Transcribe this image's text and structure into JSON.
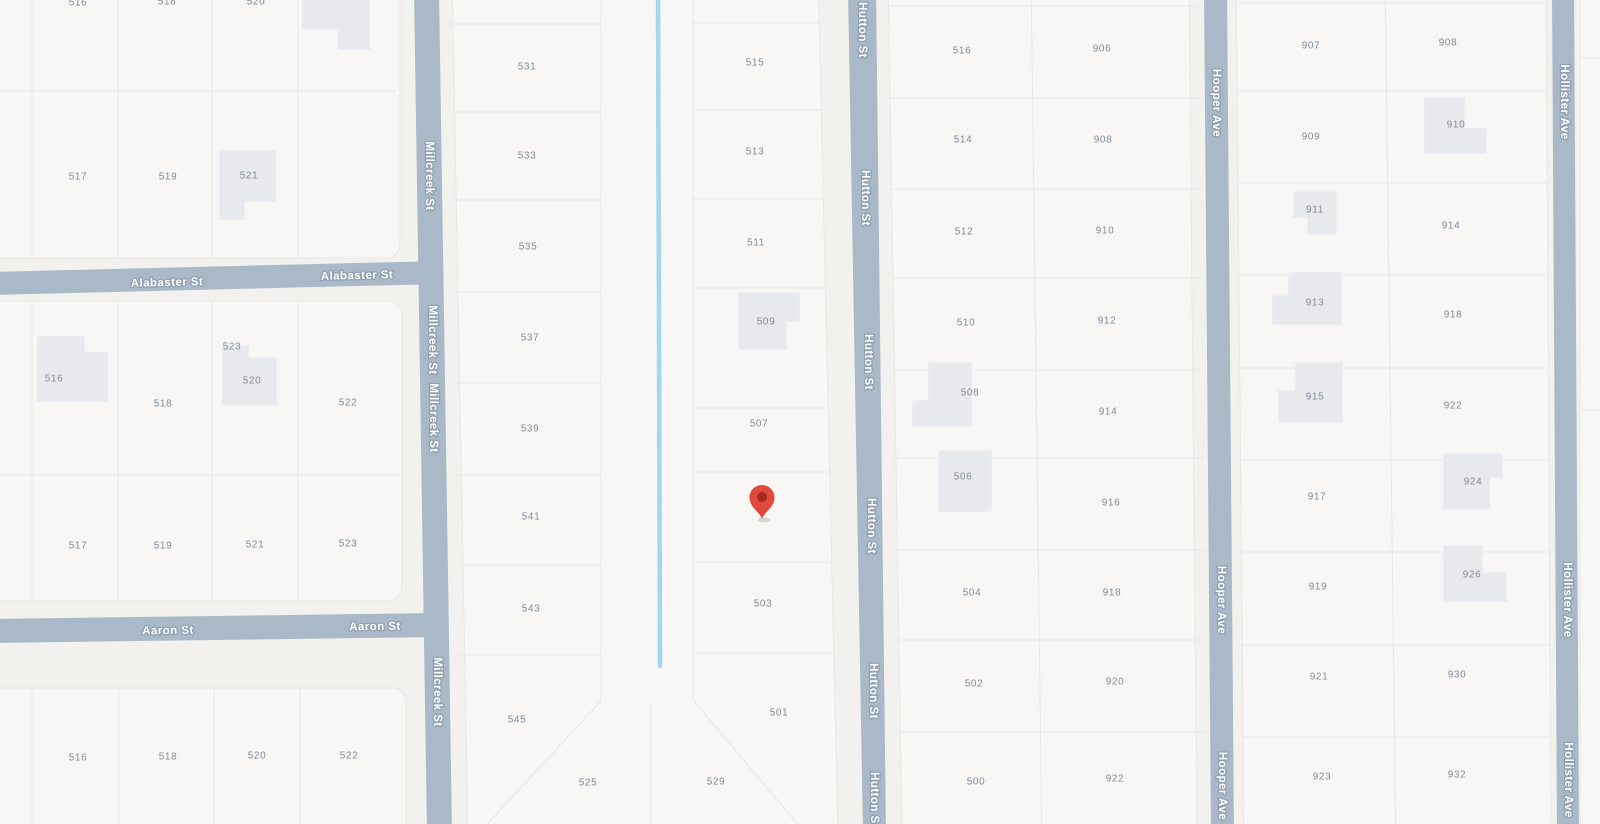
{
  "map": {
    "background": "#f2f1ee",
    "block_fill": "#f8f7f5",
    "block_stroke": "#e8e7e4",
    "parcel_line_color": "#e8e7e4",
    "building_fill": "#e8e9ed",
    "building_stroke": "#f3f4f6",
    "street_fill": "#a9b9c8",
    "street_label_color": "#ffffff",
    "street_label_halo": "#90a0b1",
    "parcel_label_color": "#828a96",
    "creek_color": "#a3d8ec",
    "pin_color": "#e0493c",
    "pin_dot_color": "#a52b1f",
    "blocks": [
      {
        "rect": [
          -30,
          -30,
          430,
          288
        ],
        "rx": 14
      },
      {
        "rect": [
          -30,
          301,
          432,
          300
        ],
        "rx": 14
      },
      {
        "rect": [
          -30,
          688,
          436,
          176
        ],
        "rx": 14
      },
      {
        "points": "452,-30 818,-30 838,834 468,834"
      },
      {
        "points": "888,-30 1189,-30 1197,834 902,834"
      },
      {
        "points": "1236,-30 1546,-30 1551,834 1244,834"
      },
      {
        "rect": [
          1580,
          -30,
          70,
          894
        ],
        "rx": 12
      }
    ],
    "parcel_lines": [
      [
        32,
        -30,
        32,
        258
      ],
      [
        118,
        -30,
        118,
        258
      ],
      [
        212,
        -30,
        212,
        258
      ],
      [
        298,
        -30,
        298,
        258
      ],
      [
        -30,
        91,
        396,
        91
      ],
      [
        32,
        301,
        32,
        601
      ],
      [
        118,
        301,
        118,
        601
      ],
      [
        212,
        301,
        212,
        601
      ],
      [
        298,
        301,
        298,
        601
      ],
      [
        -30,
        475,
        400,
        475
      ],
      [
        32,
        688,
        32,
        834
      ],
      [
        119,
        688,
        119,
        834
      ],
      [
        214,
        688,
        214,
        834
      ],
      [
        300,
        688,
        300,
        834
      ],
      [
        601,
        -30,
        601,
        701
      ],
      [
        693,
        -30,
        693,
        700
      ],
      [
        651,
        702,
        651,
        834
      ],
      [
        601,
        701,
        478,
        834
      ],
      [
        693,
        700,
        806,
        834
      ],
      [
        449,
        24,
        601,
        24
      ],
      [
        450,
        112,
        601,
        112
      ],
      [
        451,
        200,
        601,
        200
      ],
      [
        453,
        292,
        601,
        292
      ],
      [
        455,
        383,
        601,
        383
      ],
      [
        456,
        475,
        601,
        475
      ],
      [
        458,
        565,
        601,
        565
      ],
      [
        459,
        655,
        601,
        655
      ],
      [
        693,
        23,
        819,
        23
      ],
      [
        693,
        110,
        821,
        110
      ],
      [
        693,
        199,
        823,
        199
      ],
      [
        693,
        288,
        825,
        288
      ],
      [
        693,
        408,
        828,
        408
      ],
      [
        693,
        472,
        829,
        472
      ],
      [
        693,
        562,
        831,
        562
      ],
      [
        693,
        653,
        833,
        653
      ],
      [
        1031,
        -30,
        1042,
        854
      ],
      [
        885,
        6,
        1198,
        6
      ],
      [
        890,
        98,
        1200,
        98
      ],
      [
        891,
        189,
        1201,
        189
      ],
      [
        893,
        278,
        1202,
        278
      ],
      [
        894,
        370,
        1203,
        370
      ],
      [
        896,
        458,
        1204,
        458
      ],
      [
        897,
        550,
        1205,
        550
      ],
      [
        899,
        640,
        1206,
        640
      ],
      [
        900,
        732,
        1207,
        732
      ],
      [
        1385,
        -30,
        1396,
        854
      ],
      [
        1236,
        3,
        1546,
        3
      ],
      [
        1237,
        91,
        1547,
        91
      ],
      [
        1238,
        183,
        1547,
        183
      ],
      [
        1239,
        275,
        1548,
        275
      ],
      [
        1240,
        368,
        1548,
        368
      ],
      [
        1240,
        460,
        1549,
        460
      ],
      [
        1241,
        552,
        1549,
        552
      ],
      [
        1242,
        645,
        1550,
        645
      ],
      [
        1243,
        737,
        1550,
        737
      ],
      [
        1580,
        58,
        1650,
        58
      ],
      [
        1582,
        410,
        1650,
        410
      ]
    ],
    "buildings": [
      {
        "points": "302,-20 370,-20 370,50 337,50 337,30 302,30"
      },
      {
        "points": "219,150 276,150 276,202 245,202 245,220 219,220"
      },
      {
        "points": "37,336 85,336 85,352 108,352 108,402 37,402"
      },
      {
        "points": "222,345 249,345 249,357 277,357 277,406 222,406"
      },
      {
        "points": "738,292 800,292 800,322 787,322 787,350 738,350"
      },
      {
        "points": "928,362 972,362 972,427 912,427 912,400 928,400"
      },
      {
        "points": "938,450 992,450 992,512 938,512"
      },
      {
        "points": "1424,97 1465,97 1465,128 1487,128 1487,154 1424,154"
      },
      {
        "points": "1293,191 1337,191 1337,235 1307,235 1307,218 1293,218"
      },
      {
        "points": "1288,272 1342,272 1342,325 1272,325 1272,295 1288,295"
      },
      {
        "points": "1295,362 1343,362 1343,423 1278,423 1278,390 1295,390"
      },
      {
        "points": "1443,453 1503,453 1503,478 1490,478 1490,510 1443,510"
      },
      {
        "points": "1443,545 1483,545 1483,572 1507,572 1507,602 1443,602"
      }
    ],
    "creek": {
      "x1": 658,
      "y1": -10,
      "x2": 660,
      "y2": 666,
      "width": 4.5
    },
    "streets": [
      {
        "name": "Millcreek St",
        "polygon": "414,-10 439,-10 452,834 427,834",
        "labels": [
          {
            "x": 429,
            "y": 176,
            "r": 90
          },
          {
            "x": 432,
            "y": 340,
            "r": 90
          },
          {
            "x": 433,
            "y": 418,
            "r": 90
          },
          {
            "x": 437,
            "y": 692,
            "r": 90
          }
        ]
      },
      {
        "name": "Alabaster St",
        "polygon": "-10,272 440,261 440,284 -10,295",
        "labels": [
          {
            "x": 167,
            "y": 283,
            "r": -1.4
          },
          {
            "x": 357,
            "y": 276,
            "r": -1.4
          }
        ]
      },
      {
        "name": "Aaron St",
        "polygon": "-10,619 440,613 440,637 -10,643",
        "labels": [
          {
            "x": 168,
            "y": 631,
            "r": -0.8
          },
          {
            "x": 375,
            "y": 627,
            "r": -0.8
          }
        ]
      },
      {
        "name": "Hutton St",
        "polygon": "848,-10 876,-10 886,834 863,834",
        "labels": [
          {
            "x": 862,
            "y": 30,
            "r": 90
          },
          {
            "x": 865,
            "y": 198,
            "r": 90
          },
          {
            "x": 868,
            "y": 362,
            "r": 90
          },
          {
            "x": 871,
            "y": 526,
            "r": 90
          },
          {
            "x": 873,
            "y": 691,
            "r": 90
          },
          {
            "x": 874,
            "y": 800,
            "r": 90
          }
        ]
      },
      {
        "name": "Hooper Ave",
        "polygon": "1204,-10 1227,-10 1234,834 1211,834",
        "labels": [
          {
            "x": 1216,
            "y": 103,
            "r": 90
          },
          {
            "x": 1221,
            "y": 600,
            "r": 90
          },
          {
            "x": 1222,
            "y": 786,
            "r": 90
          }
        ]
      },
      {
        "name": "Hollister Ave",
        "polygon": "1552,-10 1574,-10 1579,834 1557,834",
        "labels": [
          {
            "x": 1564,
            "y": 102,
            "r": 90
          },
          {
            "x": 1567,
            "y": 600,
            "r": 90
          },
          {
            "x": 1568,
            "y": 780,
            "r": 90
          }
        ]
      }
    ],
    "parcel_labels": [
      {
        "t": "516",
        "x": 78,
        "y": 3
      },
      {
        "t": "518",
        "x": 167,
        "y": 2
      },
      {
        "t": "520",
        "x": 256,
        "y": 2
      },
      {
        "t": "517",
        "x": 78,
        "y": 177
      },
      {
        "t": "519",
        "x": 168,
        "y": 177
      },
      {
        "t": "521",
        "x": 249,
        "y": 176
      },
      {
        "t": "523",
        "x": 232,
        "y": 347
      },
      {
        "t": "516",
        "x": 54,
        "y": 379
      },
      {
        "t": "520",
        "x": 252,
        "y": 381
      },
      {
        "t": "518",
        "x": 163,
        "y": 404
      },
      {
        "t": "522",
        "x": 348,
        "y": 403
      },
      {
        "t": "517",
        "x": 78,
        "y": 546
      },
      {
        "t": "519",
        "x": 163,
        "y": 546
      },
      {
        "t": "521",
        "x": 255,
        "y": 545
      },
      {
        "t": "523",
        "x": 348,
        "y": 544
      },
      {
        "t": "516",
        "x": 78,
        "y": 758
      },
      {
        "t": "518",
        "x": 168,
        "y": 757
      },
      {
        "t": "520",
        "x": 257,
        "y": 756
      },
      {
        "t": "522",
        "x": 349,
        "y": 756
      },
      {
        "t": "531",
        "x": 527,
        "y": 67
      },
      {
        "t": "533",
        "x": 527,
        "y": 156
      },
      {
        "t": "535",
        "x": 528,
        "y": 247
      },
      {
        "t": "537",
        "x": 530,
        "y": 338
      },
      {
        "t": "539",
        "x": 530,
        "y": 429
      },
      {
        "t": "541",
        "x": 531,
        "y": 517
      },
      {
        "t": "543",
        "x": 531,
        "y": 609
      },
      {
        "t": "545",
        "x": 517,
        "y": 720
      },
      {
        "t": "525",
        "x": 588,
        "y": 783
      },
      {
        "t": "515",
        "x": 755,
        "y": 63
      },
      {
        "t": "513",
        "x": 755,
        "y": 152
      },
      {
        "t": "511",
        "x": 756,
        "y": 243
      },
      {
        "t": "509",
        "x": 766,
        "y": 322
      },
      {
        "t": "507",
        "x": 759,
        "y": 424
      },
      {
        "t": "503",
        "x": 763,
        "y": 604
      },
      {
        "t": "501",
        "x": 779,
        "y": 713
      },
      {
        "t": "529",
        "x": 716,
        "y": 782
      },
      {
        "t": "516",
        "x": 962,
        "y": 51
      },
      {
        "t": "906",
        "x": 1102,
        "y": 49
      },
      {
        "t": "514",
        "x": 963,
        "y": 140
      },
      {
        "t": "908",
        "x": 1103,
        "y": 140
      },
      {
        "t": "512",
        "x": 964,
        "y": 232
      },
      {
        "t": "910",
        "x": 1105,
        "y": 231
      },
      {
        "t": "510",
        "x": 966,
        "y": 323
      },
      {
        "t": "912",
        "x": 1107,
        "y": 321
      },
      {
        "t": "508",
        "x": 970,
        "y": 393
      },
      {
        "t": "914",
        "x": 1108,
        "y": 412
      },
      {
        "t": "506",
        "x": 963,
        "y": 477
      },
      {
        "t": "916",
        "x": 1111,
        "y": 503
      },
      {
        "t": "504",
        "x": 972,
        "y": 593
      },
      {
        "t": "918",
        "x": 1112,
        "y": 593
      },
      {
        "t": "502",
        "x": 974,
        "y": 684
      },
      {
        "t": "920",
        "x": 1115,
        "y": 682
      },
      {
        "t": "500",
        "x": 976,
        "y": 782
      },
      {
        "t": "922",
        "x": 1115,
        "y": 779
      },
      {
        "t": "907",
        "x": 1311,
        "y": 46
      },
      {
        "t": "908",
        "x": 1448,
        "y": 43
      },
      {
        "t": "909",
        "x": 1311,
        "y": 137
      },
      {
        "t": "910",
        "x": 1456,
        "y": 125
      },
      {
        "t": "911",
        "x": 1315,
        "y": 210
      },
      {
        "t": "914",
        "x": 1451,
        "y": 226
      },
      {
        "t": "913",
        "x": 1315,
        "y": 303
      },
      {
        "t": "918",
        "x": 1453,
        "y": 315
      },
      {
        "t": "915",
        "x": 1315,
        "y": 397
      },
      {
        "t": "922",
        "x": 1453,
        "y": 406
      },
      {
        "t": "917",
        "x": 1317,
        "y": 497
      },
      {
        "t": "924",
        "x": 1473,
        "y": 482
      },
      {
        "t": "919",
        "x": 1318,
        "y": 587
      },
      {
        "t": "926",
        "x": 1472,
        "y": 575
      },
      {
        "t": "921",
        "x": 1319,
        "y": 677
      },
      {
        "t": "930",
        "x": 1457,
        "y": 675
      },
      {
        "t": "923",
        "x": 1322,
        "y": 777
      },
      {
        "t": "932",
        "x": 1457,
        "y": 775
      }
    ],
    "pin": {
      "x": 762,
      "y": 519,
      "head_r": 12.5,
      "dot_r": 5
    }
  }
}
